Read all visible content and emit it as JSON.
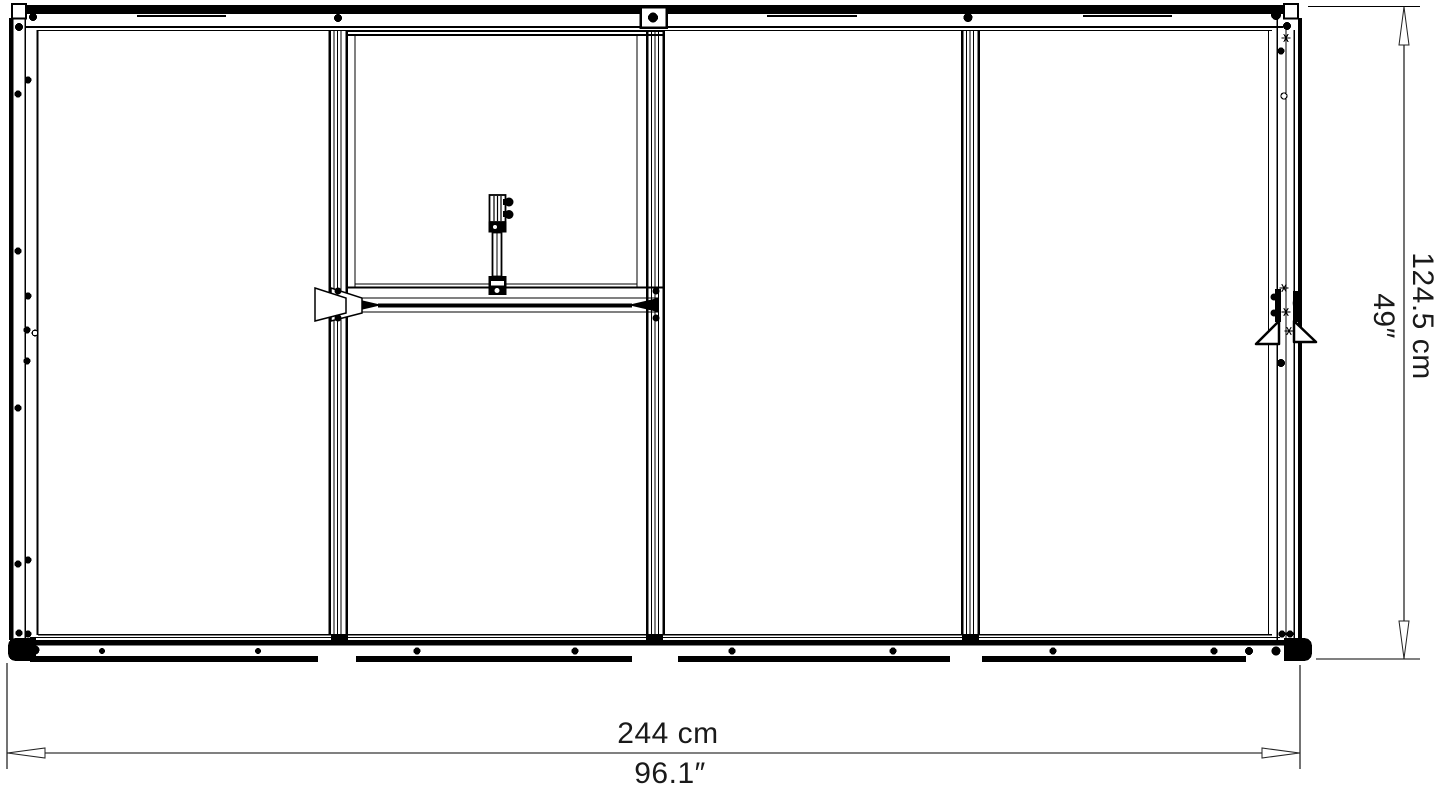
{
  "drawing": {
    "kind": "assembly-dimension-diagram",
    "colors": {
      "background": "#ffffff",
      "line": "#000000",
      "dimension_line": "#3d3d3d",
      "text": "#1a1a1a"
    }
  },
  "dimensions": {
    "width": {
      "metric": "244 cm",
      "imperial": "96.1″"
    },
    "height": {
      "metric": "124.5 cm",
      "imperial": "49″"
    }
  }
}
